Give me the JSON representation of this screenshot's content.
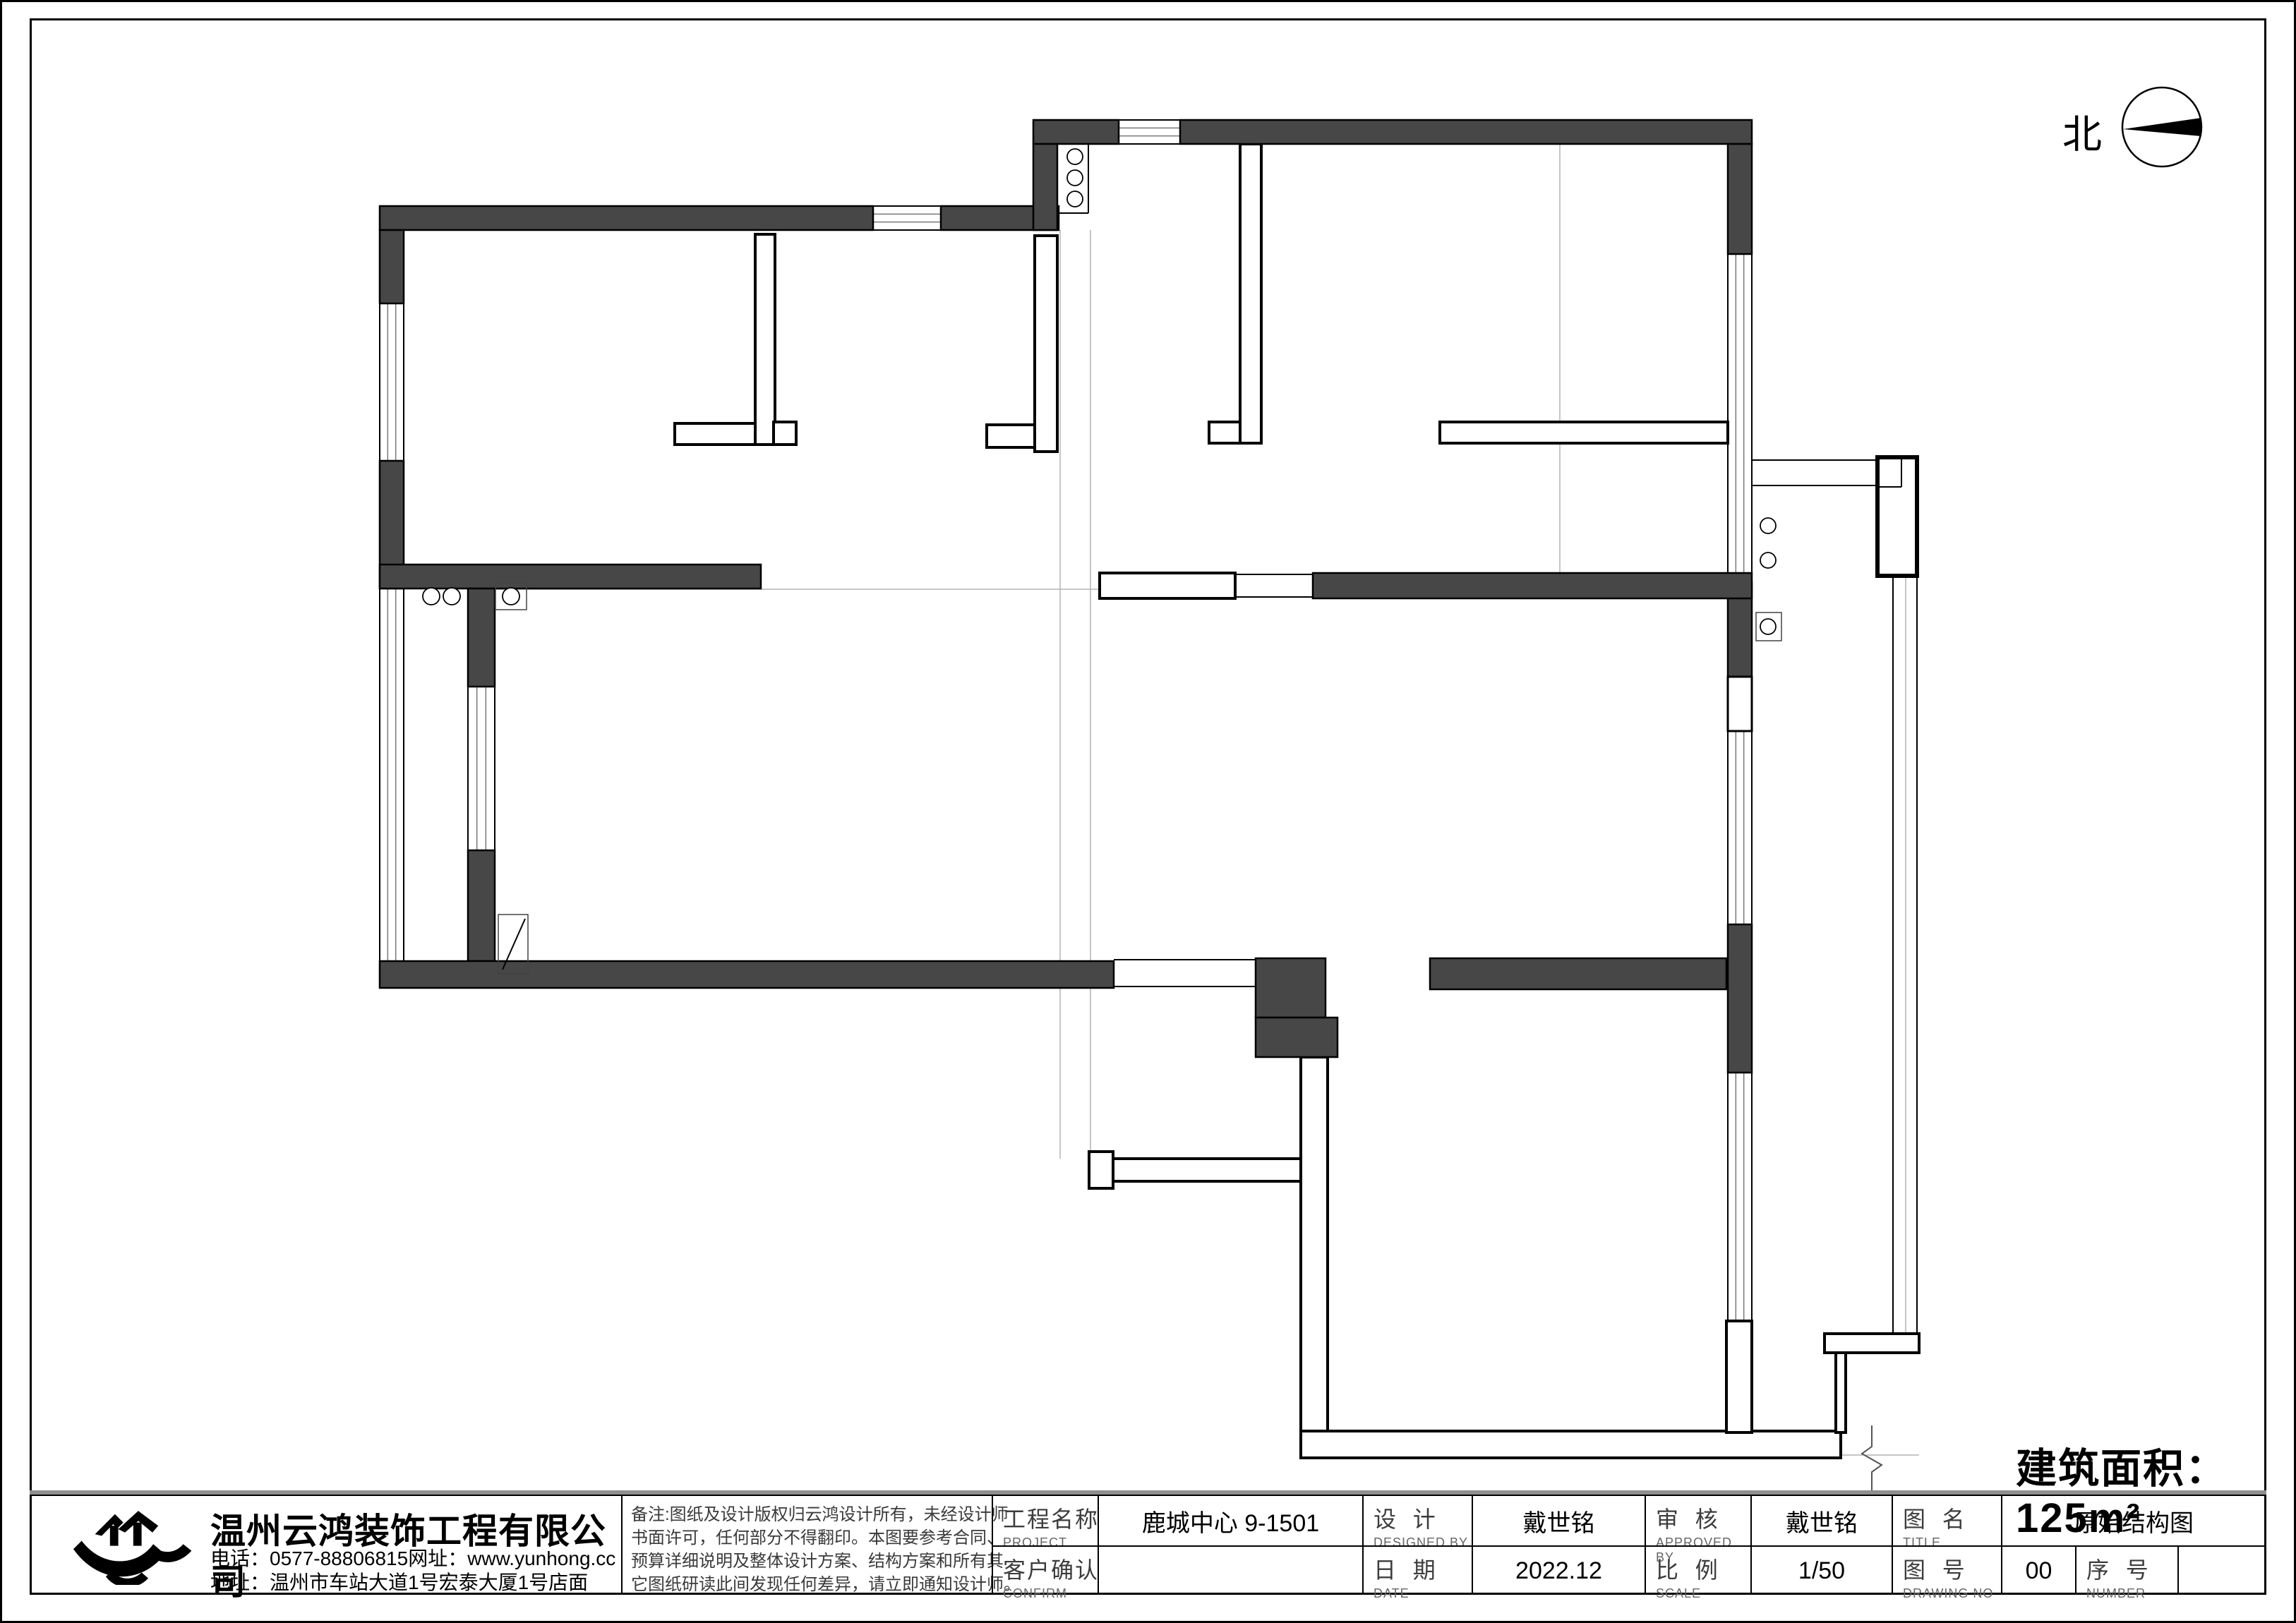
{
  "north": {
    "label": "北"
  },
  "area_label": "建筑面积：125m²",
  "title_block": {
    "company": {
      "name": "温州云鸿装饰工程有限公司",
      "phone_line": "电话：0577-88806815网址：www.yunhong.cc",
      "address_line": "地址：温州市车站大道1号宏泰大厦1号店面"
    },
    "notes": {
      "line1": "备注:图纸及设计版权归云鸿设计所有，未经设计师",
      "line2": "书面许可，任何部分不得翻印。本图要参考合同、",
      "line3": "预算详细说明及整体设计方案、结构方案和所有其",
      "line4": "它图纸研读此间发现任何差异，请立即通知设计师。"
    },
    "fields": [
      {
        "label": "工程名称",
        "sub": "PROJECT",
        "value": "鹿城中心 9-1501"
      },
      {
        "label": "客户确认",
        "sub": "CONFIRM",
        "value": ""
      },
      {
        "label": "设  计",
        "sub": "DESIGNED BY",
        "value": "戴世铭"
      },
      {
        "label": "日  期",
        "sub": "DATE",
        "value": "2022.12"
      },
      {
        "label": "审  核",
        "sub": "APPROVED BY",
        "value": "戴世铭"
      },
      {
        "label": "比  例",
        "sub": "SCALE",
        "value": "1/50"
      },
      {
        "label": "图  名",
        "sub": "TITLE",
        "value": "原始结构图"
      },
      {
        "label": "图  号",
        "sub": "DRAWING NO",
        "value": "00"
      },
      {
        "label": "序  号",
        "sub": "NUMBER",
        "value": ""
      }
    ]
  },
  "floorplan": {
    "dark_walls": [
      [
        538,
        292,
        699,
        34
      ],
      [
        1333,
        292,
        167,
        34
      ],
      [
        1464,
        170,
        121,
        34
      ],
      [
        1672,
        170,
        810,
        34
      ],
      [
        1464,
        204,
        34,
        122
      ],
      [
        538,
        326,
        34,
        104
      ],
      [
        538,
        653,
        34,
        181
      ],
      [
        538,
        800,
        540,
        34
      ],
      [
        663,
        834,
        38,
        139
      ],
      [
        663,
        1205,
        38,
        157
      ],
      [
        538,
        1362,
        1040,
        38
      ],
      [
        1779,
        1358,
        99,
        84
      ],
      [
        1779,
        1442,
        116,
        56
      ],
      [
        2026,
        1358,
        420,
        44
      ],
      [
        2448,
        204,
        34,
        156
      ],
      [
        2448,
        826,
        34,
        133
      ],
      [
        2448,
        1310,
        34,
        210
      ],
      [
        1860,
        812,
        622,
        36
      ]
    ],
    "thin_walls": [
      [
        1070,
        332,
        28,
        298
      ],
      [
        1096,
        598,
        32,
        32
      ],
      [
        956,
        600,
        114,
        30
      ],
      [
        1466,
        334,
        32,
        306
      ],
      [
        1398,
        602,
        68,
        32
      ],
      [
        1757,
        204,
        30,
        424
      ],
      [
        1713,
        598,
        44,
        30
      ],
      [
        2040,
        598,
        408,
        30
      ],
      [
        1558,
        812,
        192,
        36
      ],
      [
        1577,
        1642,
        266,
        32
      ],
      [
        1543,
        1632,
        34,
        52
      ],
      [
        1843,
        1498,
        38,
        532
      ],
      [
        1843,
        2028,
        765,
        38
      ],
      [
        2585,
        1890,
        134,
        27
      ],
      [
        2601,
        1917,
        14,
        113
      ],
      [
        2446,
        1872,
        36,
        158
      ]
    ],
    "balcony_box": [
      2660,
      648,
      56,
      168
    ],
    "windows": [
      [
        538,
        430,
        34,
        223
      ],
      [
        538,
        834,
        34,
        528
      ],
      [
        1237,
        292,
        96,
        34
      ],
      [
        1585,
        170,
        87,
        34
      ],
      [
        663,
        973,
        38,
        232
      ],
      [
        2448,
        360,
        34,
        466
      ],
      [
        2448,
        1036,
        34,
        274
      ],
      [
        2448,
        1520,
        34,
        352
      ]
    ],
    "openings": [
      [
        2448,
        959,
        34,
        77
      ]
    ],
    "lines": [
      [
        1578,
        1360,
        1779,
        1360
      ],
      [
        1578,
        1398,
        1779,
        1398
      ],
      [
        1750,
        814,
        1860,
        814
      ],
      [
        1750,
        846,
        1860,
        846
      ],
      [
        1542,
        204,
        1542,
        302
      ],
      [
        1498,
        302,
        1542,
        302
      ],
      [
        2482,
        652,
        2660,
        652
      ],
      [
        2482,
        688,
        2660,
        688
      ],
      [
        2660,
        690,
        2694,
        690
      ],
      [
        2694,
        648,
        2694,
        690
      ],
      [
        2682,
        816,
        2682,
        1890
      ],
      [
        2716,
        816,
        2716,
        1890
      ],
      [
        712,
        1374,
        744,
        1302
      ]
    ],
    "ref_lines": [
      [
        1502,
        326,
        1502,
        1642
      ],
      [
        1545,
        326,
        1545,
        1642
      ],
      [
        2210,
        204,
        2210,
        812
      ],
      [
        2700,
        816,
        2700,
        1890
      ],
      [
        701,
        835,
        1558,
        835
      ],
      [
        2608,
        2062,
        2719,
        2062
      ]
    ],
    "outline_boxes": [
      [
        702,
        826,
        44,
        38
      ],
      [
        2488,
        868,
        36,
        40
      ],
      [
        706,
        1296,
        42,
        84
      ]
    ],
    "circles": [
      [
        1523,
        222,
        11
      ],
      [
        1523,
        252,
        11
      ],
      [
        1523,
        282,
        11
      ],
      [
        611,
        845,
        12
      ],
      [
        640,
        845,
        12
      ],
      [
        724,
        845,
        12
      ],
      [
        2505,
        745,
        11
      ],
      [
        2505,
        794,
        11
      ],
      [
        2505,
        888,
        11
      ]
    ],
    "break_points": "2652,2020 2652,2050 2638,2060 2666,2076 2652,2086 2652,2112",
    "north_circle": [
      3063,
      180,
      56
    ],
    "north_needle": "3008,183 3119,167 3119,193"
  }
}
